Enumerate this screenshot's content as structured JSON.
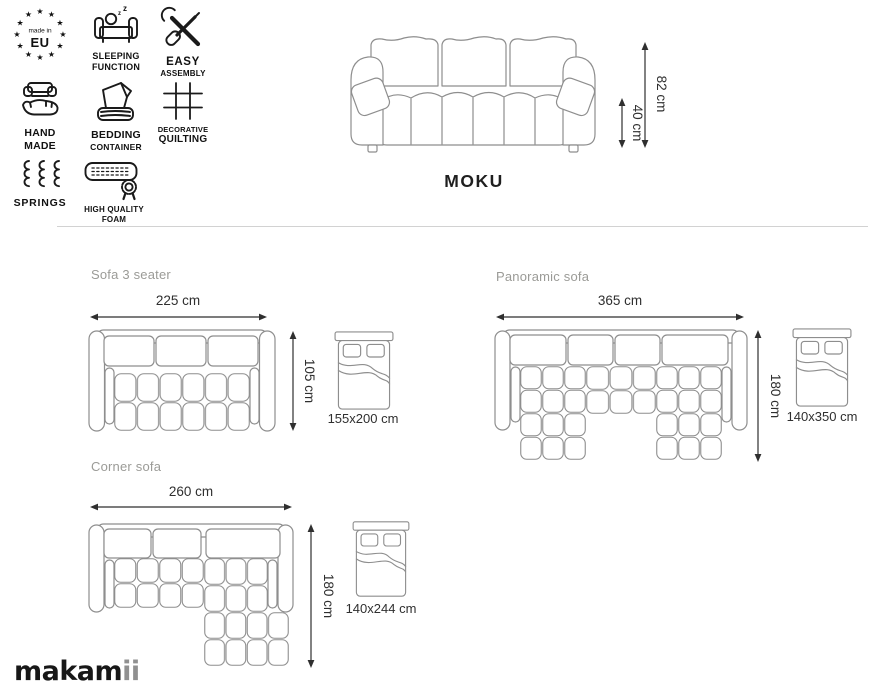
{
  "features": [
    {
      "name": "made-in-eu",
      "lines": [
        "made in",
        "EU"
      ]
    },
    {
      "name": "sleeping-function",
      "lines": [
        "SLEEPING",
        "FUNCTION"
      ]
    },
    {
      "name": "easy-assembly",
      "lines": [
        "EASY",
        "ASSEMBLY"
      ]
    },
    {
      "name": "hand-made",
      "lines": [
        "HAND",
        "MADE"
      ]
    },
    {
      "name": "bedding-container",
      "lines": [
        "BEDDING",
        "CONTAINER"
      ]
    },
    {
      "name": "decorative-quilting",
      "lines": [
        "DECORATIVE",
        "QUILTING"
      ]
    },
    {
      "name": "springs",
      "lines": [
        "SPRINGS"
      ]
    },
    {
      "name": "high-quality-foam",
      "lines": [
        "HIGH QUALITY",
        "FOAM"
      ]
    }
  ],
  "product": {
    "name": "MOKU",
    "total_height": "82 cm",
    "seat_height": "40 cm"
  },
  "variants": [
    {
      "name": "Sofa 3 seater",
      "width": "225 cm",
      "depth": "105 cm",
      "sleeping_area": "155x200 cm"
    },
    {
      "name": "Panoramic sofa",
      "width": "365 cm",
      "depth": "180 cm",
      "sleeping_area": "140x350 cm"
    },
    {
      "name": "Corner sofa",
      "width": "260 cm",
      "depth": "180 cm",
      "sleeping_area": "140x244 cm"
    }
  ],
  "brand": {
    "logo_prefix": "makam",
    "logo_suffix": "ii"
  },
  "colors": {
    "line_art": "#8e8e8e",
    "dimension": "#2f2f2f",
    "icon": "#1a1a1a",
    "section_title": "#9b9b97",
    "divider": "#d2d2d2",
    "logo_suffix": "#909090",
    "background": "#ffffff"
  }
}
